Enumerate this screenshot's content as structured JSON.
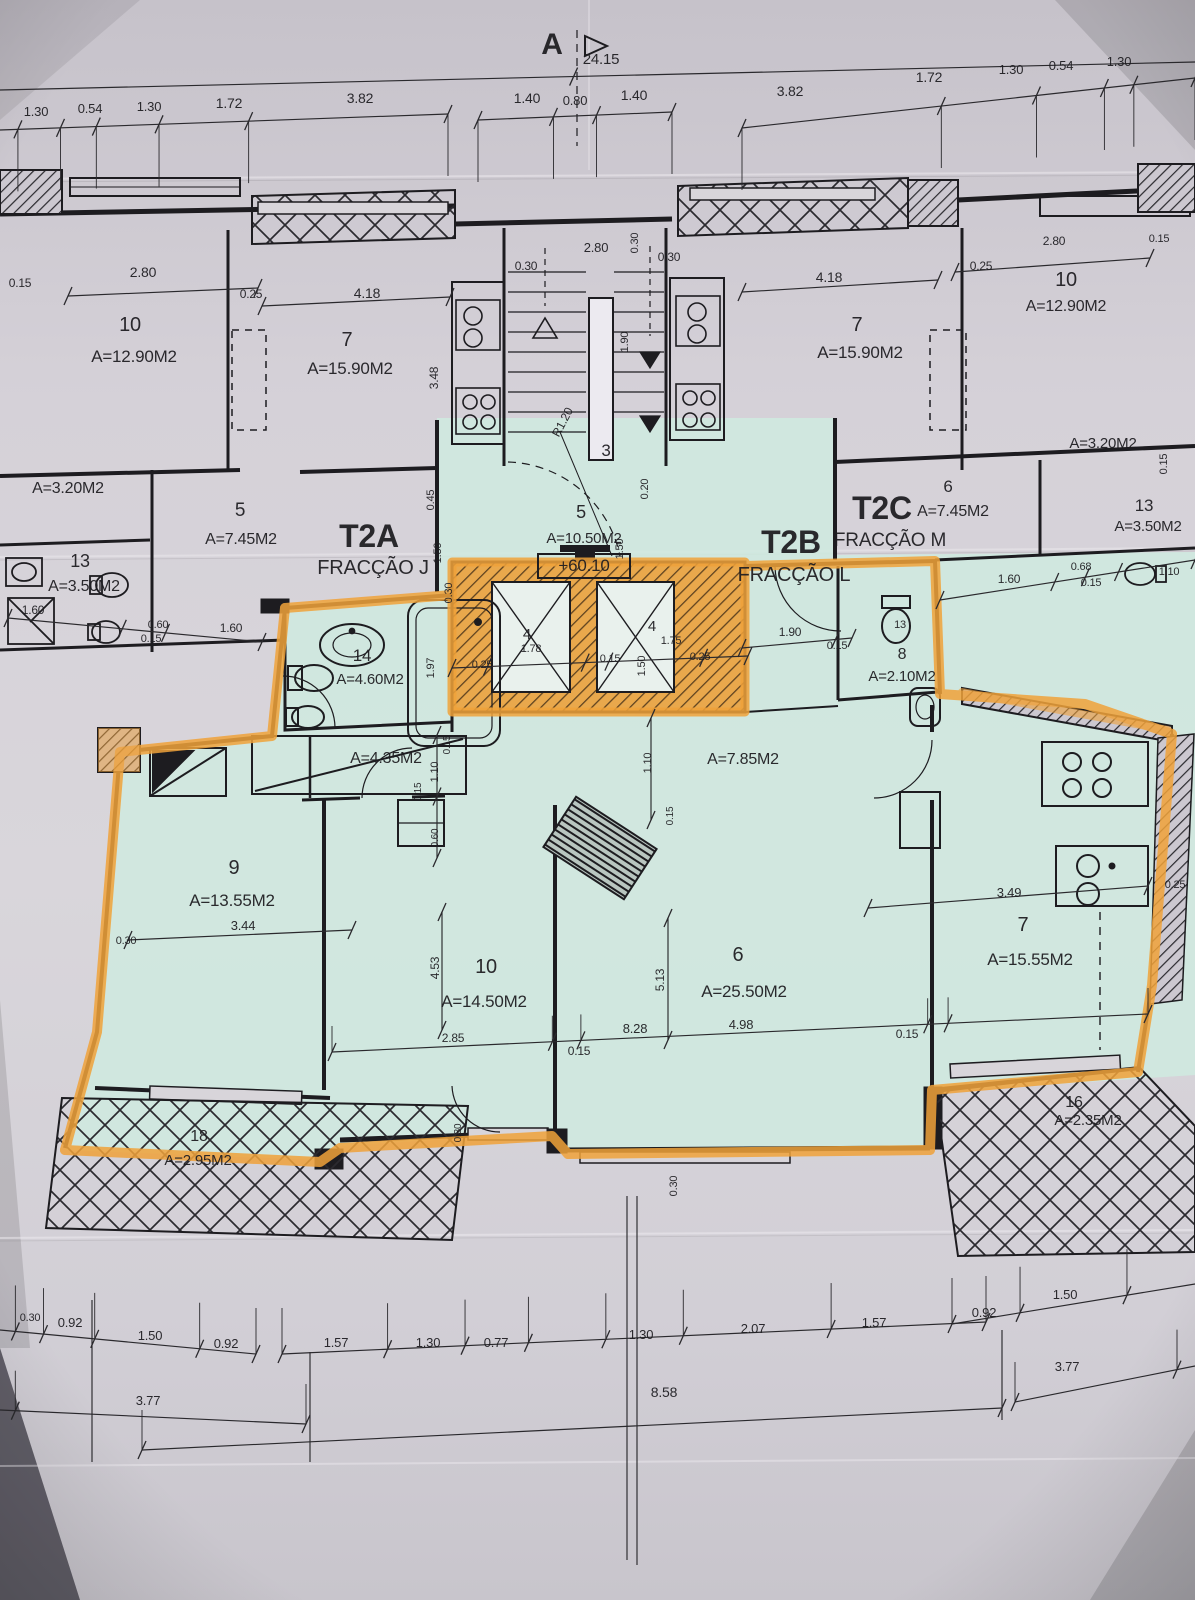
{
  "colors": {
    "paper": "#d5d1d8",
    "teal_highlight": "#cfe9df",
    "highlighter_orange": "#f0a23a",
    "ink": "#1d1c20"
  },
  "section": {
    "letter": "A",
    "total_width": "24.15"
  },
  "level_mark": "+60.10",
  "units": [
    {
      "code": "T2A",
      "fraction": "FRACÇÃO J"
    },
    {
      "code": "T2B",
      "fraction": "FRACÇÃO L",
      "highlighted": true,
      "level": "+60.10"
    },
    {
      "code": "T2C",
      "fraction": "FRACÇÃO M"
    }
  ],
  "annotations": [
    {
      "n": "section-letter",
      "t": "A",
      "x": 552,
      "y": 54,
      "s": 30,
      "b": 1
    },
    {
      "n": "dim-total",
      "t": "24.15",
      "x": 601,
      "y": 64,
      "s": 15
    },
    {
      "n": "dim-tc-1",
      "t": "1.40",
      "x": 527,
      "y": 103,
      "s": 14
    },
    {
      "n": "dim-tc-2",
      "t": "0.80",
      "x": 575,
      "y": 105,
      "s": 13
    },
    {
      "n": "dim-tc-3",
      "t": "1.40",
      "x": 634,
      "y": 100,
      "s": 14
    },
    {
      "n": "dim-tl-1",
      "t": "1.30",
      "x": 36,
      "y": 116,
      "s": 13
    },
    {
      "n": "dim-tl-2",
      "t": "0.54",
      "x": 90,
      "y": 113,
      "s": 13
    },
    {
      "n": "dim-tl-3",
      "t": "1.30",
      "x": 149,
      "y": 111,
      "s": 13
    },
    {
      "n": "dim-tl-4",
      "t": "1.72",
      "x": 229,
      "y": 108,
      "s": 14
    },
    {
      "n": "dim-tl-5",
      "t": "3.82",
      "x": 360,
      "y": 103,
      "s": 14
    },
    {
      "n": "dim-tr-1",
      "t": "3.82",
      "x": 790,
      "y": 96,
      "s": 14
    },
    {
      "n": "dim-tr-2",
      "t": "1.72",
      "x": 929,
      "y": 82,
      "s": 14
    },
    {
      "n": "dim-tr-3",
      "t": "1.30",
      "x": 1011,
      "y": 74,
      "s": 13
    },
    {
      "n": "dim-tr-4",
      "t": "0.54",
      "x": 1061,
      "y": 70,
      "s": 13
    },
    {
      "n": "dim-tr-5",
      "t": "1.30",
      "x": 1119,
      "y": 66,
      "s": 13
    },
    {
      "n": "dim-ul-015",
      "t": "0.15",
      "x": 20,
      "y": 287,
      "s": 12
    },
    {
      "n": "dim-ul-280",
      "t": "2.80",
      "x": 143,
      "y": 277,
      "s": 14
    },
    {
      "n": "dim-ul-025",
      "t": "0.25",
      "x": 251,
      "y": 298,
      "s": 12
    },
    {
      "n": "dim-ul-418",
      "t": "4.18",
      "x": 367,
      "y": 298,
      "s": 14
    },
    {
      "n": "room-ul-10-num",
      "t": "10",
      "x": 130,
      "y": 331,
      "s": 20
    },
    {
      "n": "room-ul-10-area",
      "t": "A=12.90M2",
      "x": 134,
      "y": 362,
      "s": 17
    },
    {
      "n": "room-ul-7-num",
      "t": "7",
      "x": 347,
      "y": 346,
      "s": 20
    },
    {
      "n": "room-ul-7-area",
      "t": "A=15.90M2",
      "x": 350,
      "y": 374,
      "s": 17
    },
    {
      "n": "dim-ul-348",
      "t": "3.48",
      "x": 438,
      "y": 378,
      "r": -90,
      "s": 12
    },
    {
      "n": "room-ul-balc-area",
      "t": "A=3.20M2",
      "x": 68,
      "y": 493,
      "s": 16
    },
    {
      "n": "room-ul-5-num",
      "t": "5",
      "x": 240,
      "y": 516,
      "s": 19
    },
    {
      "n": "room-ul-5-area",
      "t": "A=7.45M2",
      "x": 241,
      "y": 544,
      "s": 16
    },
    {
      "n": "room-ul-13-num",
      "t": "13",
      "x": 80,
      "y": 567,
      "s": 18
    },
    {
      "n": "room-ul-13-area",
      "t": "A=3.50M2",
      "x": 84,
      "y": 591,
      "s": 16
    },
    {
      "n": "dim-ul-160a",
      "t": "1.60",
      "x": 33,
      "y": 614,
      "s": 12
    },
    {
      "n": "dim-ul-060",
      "t": "0.60",
      "x": 158,
      "y": 628,
      "s": 11
    },
    {
      "n": "dim-ul-015b",
      "t": "0.15",
      "x": 151,
      "y": 642,
      "s": 11
    },
    {
      "n": "dim-ul-160b",
      "t": "1.60",
      "x": 231,
      "y": 632,
      "s": 12
    },
    {
      "n": "dim-st-280",
      "t": "2.80",
      "x": 596,
      "y": 252,
      "s": 13
    },
    {
      "n": "dim-st-030a",
      "t": "0.30",
      "x": 526,
      "y": 270,
      "s": 12
    },
    {
      "n": "dim-st-030b",
      "t": "0.30",
      "x": 669,
      "y": 261,
      "s": 12
    },
    {
      "n": "dim-st-030c",
      "t": "0.30",
      "x": 638,
      "y": 243,
      "r": -90,
      "s": 11
    },
    {
      "n": "dim-st-190",
      "t": "1.90",
      "x": 628,
      "y": 342,
      "r": -90,
      "s": 11
    },
    {
      "n": "dim-st-r120",
      "t": "R1.20",
      "x": 566,
      "y": 424,
      "r": -62,
      "s": 12
    },
    {
      "n": "room-stair-num",
      "t": "3",
      "x": 606,
      "y": 456,
      "s": 17
    },
    {
      "n": "dim-c-045",
      "t": "0.45",
      "x": 434,
      "y": 500,
      "r": -90,
      "s": 11
    },
    {
      "n": "dim-c-150a",
      "t": "1.50",
      "x": 441,
      "y": 553,
      "r": -90,
      "s": 11
    },
    {
      "n": "dim-c-030",
      "t": "0.30",
      "x": 452,
      "y": 593,
      "r": -90,
      "s": 11
    },
    {
      "n": "room-c-5-num",
      "t": "5",
      "x": 581,
      "y": 518,
      "s": 18
    },
    {
      "n": "room-c-5-area",
      "t": "A=10.50M2",
      "x": 584,
      "y": 543,
      "s": 15
    },
    {
      "n": "level-mark",
      "t": "+60.10",
      "x": 584,
      "y": 571,
      "s": 17,
      "box": 1
    },
    {
      "n": "dim-c-150b",
      "t": "1.50",
      "x": 623,
      "y": 549,
      "r": -90,
      "s": 11
    },
    {
      "n": "dim-c-020",
      "t": "0.20",
      "x": 648,
      "y": 489,
      "r": -90,
      "s": 11
    },
    {
      "n": "unit-t2a-code",
      "t": "T2A",
      "x": 369,
      "y": 547,
      "s": 32,
      "b": 1
    },
    {
      "n": "unit-t2a-fraction",
      "t": "FRACÇÃO J",
      "x": 373,
      "y": 574,
      "s": 20
    },
    {
      "n": "unit-t2b-code",
      "t": "T2B",
      "x": 791,
      "y": 553,
      "s": 32,
      "b": 1
    },
    {
      "n": "unit-t2b-fraction",
      "t": "FRACÇÃO L",
      "x": 794,
      "y": 581,
      "s": 20
    },
    {
      "n": "unit-t2c-code",
      "t": "T2C",
      "x": 882,
      "y": 519,
      "s": 32,
      "b": 1
    },
    {
      "n": "unit-t2c-fraction",
      "t": "FRACÇÃO M",
      "x": 890,
      "y": 546,
      "s": 19
    },
    {
      "n": "room-t2c-6-num",
      "t": "6",
      "x": 948,
      "y": 492,
      "s": 17
    },
    {
      "n": "room-t2c-6-area",
      "t": "A=7.45M2",
      "x": 953,
      "y": 516,
      "s": 16
    },
    {
      "n": "room-ur-13-num",
      "t": "13",
      "x": 1144,
      "y": 511,
      "s": 17
    },
    {
      "n": "room-ur-13-area",
      "t": "A=3.50M2",
      "x": 1148,
      "y": 531,
      "s": 15
    },
    {
      "n": "dim-ur-160",
      "t": "1.60",
      "x": 1009,
      "y": 583,
      "s": 12
    },
    {
      "n": "dim-ur-068",
      "t": "0.68",
      "x": 1081,
      "y": 570,
      "s": 11
    },
    {
      "n": "dim-ur-015",
      "t": "0.15",
      "x": 1091,
      "y": 586,
      "s": 11
    },
    {
      "n": "dim-ur-110",
      "t": "1.10",
      "x": 1169,
      "y": 575,
      "s": 11
    },
    {
      "n": "room-ur-balc-area",
      "t": "A=3.20M2",
      "x": 1103,
      "y": 448,
      "s": 15
    },
    {
      "n": "dim-ur-015b",
      "t": "0.15",
      "x": 1167,
      "y": 464,
      "r": -90,
      "s": 11
    },
    {
      "n": "room-ur-10-num",
      "t": "10",
      "x": 1066,
      "y": 286,
      "s": 20
    },
    {
      "n": "room-ur-10-area",
      "t": "A=12.90M2",
      "x": 1066,
      "y": 311,
      "s": 16
    },
    {
      "n": "room-ur-7-num",
      "t": "7",
      "x": 857,
      "y": 331,
      "s": 20
    },
    {
      "n": "room-ur-7-area",
      "t": "A=15.90M2",
      "x": 860,
      "y": 358,
      "s": 17
    },
    {
      "n": "dim-ur-418",
      "t": "4.18",
      "x": 829,
      "y": 282,
      "s": 14
    },
    {
      "n": "dim-ur-025",
      "t": "0.25",
      "x": 981,
      "y": 270,
      "s": 12
    },
    {
      "n": "dim-ur-280",
      "t": "2.80",
      "x": 1054,
      "y": 245,
      "s": 12
    },
    {
      "n": "dim-ur-015c",
      "t": "0.15",
      "x": 1159,
      "y": 242,
      "s": 11
    },
    {
      "n": "room-14-num",
      "t": "14",
      "x": 362,
      "y": 661,
      "s": 17
    },
    {
      "n": "room-14-area",
      "t": "A=4.60M2",
      "x": 370,
      "y": 684,
      "s": 15
    },
    {
      "n": "dim-e-197",
      "t": "1.97",
      "x": 434,
      "y": 668,
      "r": -90,
      "s": 11
    },
    {
      "n": "dim-e-025a",
      "t": "0.25",
      "x": 482,
      "y": 668,
      "s": 11
    },
    {
      "n": "elev-1-num",
      "t": "4",
      "x": 527,
      "y": 639,
      "s": 15
    },
    {
      "n": "dim-e-178",
      "t": "1.78",
      "x": 531,
      "y": 652,
      "s": 11
    },
    {
      "n": "dim-e-015",
      "t": "0.15",
      "x": 610,
      "y": 662,
      "s": 11
    },
    {
      "n": "elev-2-num",
      "t": "4",
      "x": 652,
      "y": 631,
      "s": 15
    },
    {
      "n": "dim-e-175",
      "t": "1.75",
      "x": 671,
      "y": 644,
      "s": 11
    },
    {
      "n": "dim-e-150",
      "t": "1.50",
      "x": 645,
      "y": 666,
      "r": -90,
      "s": 11
    },
    {
      "n": "dim-e-025b",
      "t": "0.25",
      "x": 700,
      "y": 660,
      "s": 11
    },
    {
      "n": "dim-wc-190",
      "t": "1.90",
      "x": 790,
      "y": 636,
      "s": 12
    },
    {
      "n": "dim-wc-015",
      "t": "0.15",
      "x": 837,
      "y": 649,
      "s": 11
    },
    {
      "n": "dim-wc-13",
      "t": "13",
      "x": 900,
      "y": 628,
      "s": 11
    },
    {
      "n": "room-8-num",
      "t": "8",
      "x": 902,
      "y": 659,
      "s": 16
    },
    {
      "n": "room-8-area",
      "t": "A=2.10M2",
      "x": 902,
      "y": 681,
      "s": 15
    },
    {
      "n": "hall-435-area",
      "t": "A=4.35M2",
      "x": 386,
      "y": 763,
      "s": 16
    },
    {
      "n": "dim-h-110a",
      "t": "1.10",
      "x": 438,
      "y": 772,
      "r": -90,
      "s": 11
    },
    {
      "n": "dim-h-015a",
      "t": "0.15",
      "x": 421,
      "y": 792,
      "r": -90,
      "s": 10
    },
    {
      "n": "dim-h-015b",
      "t": "0.15",
      "x": 450,
      "y": 745,
      "r": -90,
      "s": 10
    },
    {
      "n": "dim-h-060",
      "t": "0.60",
      "x": 438,
      "y": 838,
      "r": -90,
      "s": 10
    },
    {
      "n": "hall-785-area",
      "t": "A=7.85M2",
      "x": 743,
      "y": 764,
      "s": 16
    },
    {
      "n": "dim-h-110b",
      "t": "1.10",
      "x": 651,
      "y": 763,
      "r": -90,
      "s": 11
    },
    {
      "n": "dim-h-015c",
      "t": "0.15",
      "x": 673,
      "y": 816,
      "r": -90,
      "s": 10
    },
    {
      "n": "room-9-num",
      "t": "9",
      "x": 234,
      "y": 874,
      "s": 20
    },
    {
      "n": "room-9-area",
      "t": "A=13.55M2",
      "x": 232,
      "y": 906,
      "s": 17
    },
    {
      "n": "dim-9-344",
      "t": "3.44",
      "x": 243,
      "y": 930,
      "s": 13
    },
    {
      "n": "dim-9-030",
      "t": "0.30",
      "x": 126,
      "y": 944,
      "s": 11
    },
    {
      "n": "room-10-num",
      "t": "10",
      "x": 486,
      "y": 973,
      "s": 20
    },
    {
      "n": "room-10-area",
      "t": "A=14.50M2",
      "x": 484,
      "y": 1007,
      "s": 17
    },
    {
      "n": "dim-10-453",
      "t": "4.53",
      "x": 439,
      "y": 968,
      "r": -90,
      "s": 12
    },
    {
      "n": "dim-10-285",
      "t": "2.85",
      "x": 453,
      "y": 1042,
      "s": 12
    },
    {
      "n": "dim-10-015",
      "t": "0.15",
      "x": 579,
      "y": 1055,
      "s": 12
    },
    {
      "n": "dim-6-513",
      "t": "5.13",
      "x": 664,
      "y": 980,
      "r": -90,
      "s": 12
    },
    {
      "n": "room-6-num",
      "t": "6",
      "x": 738,
      "y": 961,
      "s": 20
    },
    {
      "n": "room-6-area",
      "t": "A=25.50M2",
      "x": 744,
      "y": 997,
      "s": 17
    },
    {
      "n": "dim-6-828",
      "t": "8.28",
      "x": 635,
      "y": 1033,
      "s": 13
    },
    {
      "n": "dim-6-498",
      "t": "4.98",
      "x": 741,
      "y": 1029,
      "s": 13
    },
    {
      "n": "room-7k-num",
      "t": "7",
      "x": 1023,
      "y": 931,
      "s": 20
    },
    {
      "n": "room-7k-area",
      "t": "A=15.55M2",
      "x": 1030,
      "y": 965,
      "s": 17
    },
    {
      "n": "dim-7k-349",
      "t": "3.49",
      "x": 1009,
      "y": 897,
      "s": 13
    },
    {
      "n": "dim-7k-025",
      "t": "0.25",
      "x": 1175,
      "y": 888,
      "s": 11
    },
    {
      "n": "dim-7k-015",
      "t": "0.15",
      "x": 907,
      "y": 1038,
      "s": 12
    },
    {
      "n": "dim-b-030a",
      "t": "0.30",
      "x": 461,
      "y": 1133,
      "r": -90,
      "s": 10
    },
    {
      "n": "dim-b-030b",
      "t": "0.30",
      "x": 677,
      "y": 1186,
      "r": -90,
      "s": 11
    },
    {
      "n": "balcony-18-num",
      "t": "18",
      "x": 199,
      "y": 1141,
      "s": 16
    },
    {
      "n": "balcony-18-area",
      "t": "A=2.95M2",
      "x": 198,
      "y": 1165,
      "s": 15
    },
    {
      "n": "balcony-16-num",
      "t": "16",
      "x": 1074,
      "y": 1107,
      "s": 16
    },
    {
      "n": "balcony-16-area",
      "t": "A=2.35M2",
      "x": 1088,
      "y": 1125,
      "s": 15
    },
    {
      "n": "dim-ba-030",
      "t": "0.30",
      "x": 30,
      "y": 1321,
      "s": 11
    },
    {
      "n": "dim-ba-092a",
      "t": "0.92",
      "x": 70,
      "y": 1327,
      "s": 13
    },
    {
      "n": "dim-ba-150a",
      "t": "1.50",
      "x": 150,
      "y": 1340,
      "s": 13
    },
    {
      "n": "dim-ba-092b",
      "t": "0.92",
      "x": 226,
      "y": 1348,
      "s": 13
    },
    {
      "n": "dim-ba-157a",
      "t": "1.57",
      "x": 336,
      "y": 1347,
      "s": 13
    },
    {
      "n": "dim-ba-130a",
      "t": "1.30",
      "x": 428,
      "y": 1347,
      "s": 13
    },
    {
      "n": "dim-ba-077",
      "t": "0.77",
      "x": 496,
      "y": 1347,
      "s": 13
    },
    {
      "n": "dim-ba-130b",
      "t": "1.30",
      "x": 641,
      "y": 1339,
      "s": 13
    },
    {
      "n": "dim-ba-207",
      "t": "2.07",
      "x": 753,
      "y": 1333,
      "s": 13
    },
    {
      "n": "dim-ba-157b",
      "t": "1.57",
      "x": 874,
      "y": 1327,
      "s": 13
    },
    {
      "n": "dim-ba-092c",
      "t": "0.92",
      "x": 984,
      "y": 1317,
      "s": 13
    },
    {
      "n": "dim-ba-150b",
      "t": "1.50",
      "x": 1065,
      "y": 1299,
      "s": 13
    },
    {
      "n": "dim-bb-377a",
      "t": "3.77",
      "x": 148,
      "y": 1405,
      "s": 13
    },
    {
      "n": "dim-bb-858",
      "t": "8.58",
      "x": 664,
      "y": 1397,
      "s": 14
    },
    {
      "n": "dim-bb-377b",
      "t": "3.77",
      "x": 1067,
      "y": 1371,
      "s": 13
    }
  ]
}
